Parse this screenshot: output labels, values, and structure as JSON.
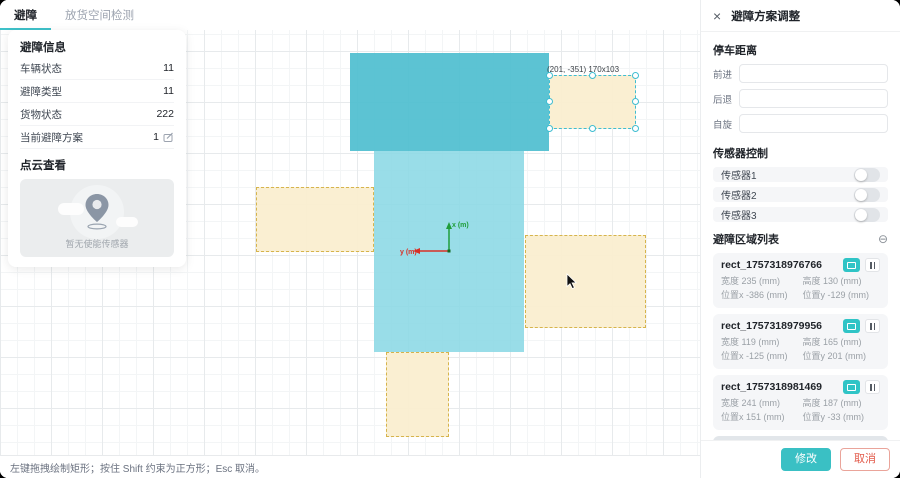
{
  "tabs": [
    {
      "label": "避障",
      "active": true
    },
    {
      "label": "放货空间检测",
      "active": false
    }
  ],
  "info_panel": {
    "title": "避障信息",
    "rows": [
      {
        "label": "车辆状态",
        "value": "11"
      },
      {
        "label": "避障类型",
        "value": "11"
      },
      {
        "label": "货物状态",
        "value": "222"
      },
      {
        "label": "当前避障方案",
        "value": "1"
      }
    ],
    "pointcloud_title": "点云查看",
    "pointcloud_empty": "暂无使能传感器"
  },
  "canvas": {
    "axis_x_label": "x (m)",
    "axis_y_label": "y (m)",
    "selected_label": "(201, -351) 170x103",
    "shapes": [
      {
        "name": "vehicle-region-top",
        "cls": "solid-dark",
        "x": 350,
        "y": 53,
        "w": 199,
        "h": 98,
        "interactable": false
      },
      {
        "name": "vehicle-region-bottom",
        "cls": "solid-light",
        "x": 374,
        "y": 151,
        "w": 150,
        "h": 201,
        "interactable": false
      },
      {
        "name": "avoid-zone-left",
        "cls": "zone",
        "x": 256,
        "y": 187,
        "w": 118,
        "h": 65,
        "interactable": true
      },
      {
        "name": "avoid-zone-right",
        "cls": "zone",
        "x": 525,
        "y": 235,
        "w": 121,
        "h": 93,
        "interactable": true
      },
      {
        "name": "avoid-zone-bottom",
        "cls": "zone",
        "x": 386,
        "y": 352,
        "w": 63,
        "h": 85,
        "interactable": true
      },
      {
        "name": "avoid-zone-selected",
        "cls": "zone selected",
        "x": 549,
        "y": 75,
        "w": 87,
        "h": 54,
        "interactable": true,
        "selected": true
      }
    ]
  },
  "status_bar": {
    "text": "左键拖拽绘制矩形；按住 Shift 约束为正方形；Esc 取消。"
  },
  "adjust_panel": {
    "close_icon": "×",
    "title": "避障方案调整",
    "stop_distance": {
      "title": "停车距离",
      "fields": [
        {
          "label": "前进",
          "value": ""
        },
        {
          "label": "后退",
          "value": ""
        },
        {
          "label": "自旋",
          "value": ""
        }
      ]
    },
    "sensor_control": {
      "title": "传感器控制",
      "sensors": [
        {
          "label": "传感器1",
          "on": false
        },
        {
          "label": "传感器2",
          "on": false
        },
        {
          "label": "传感器3",
          "on": false
        }
      ]
    },
    "area_list": {
      "title": "避障区域列表",
      "collapse_icon": "⊖",
      "items": [
        {
          "name": "rect_1757318976766",
          "width": "宽度 235 (mm)",
          "height": "高度 130 (mm)",
          "pos_x": "位置x -386 (mm)",
          "pos_y": "位置y -129 (mm)",
          "selected": false
        },
        {
          "name": "rect_1757318979956",
          "width": "宽度 119 (mm)",
          "height": "高度 165 (mm)",
          "pos_x": "位置x -125 (mm)",
          "pos_y": "位置y 201 (mm)",
          "selected": false
        },
        {
          "name": "rect_1757318981469",
          "width": "宽度 241 (mm)",
          "height": "高度 187 (mm)",
          "pos_x": "位置x 151 (mm)",
          "pos_y": "位置y -33 (mm)",
          "selected": false
        },
        {
          "name": "rect_1757318983565",
          "width": "宽度 170 (mm)",
          "height": "高度 103 (mm)",
          "pos_x": "位置x 201 (mm)",
          "pos_y": "位置y -351 (mm)",
          "selected": true
        }
      ]
    },
    "footer": {
      "confirm": "修改",
      "cancel": "取消"
    }
  },
  "colors": {
    "accent_teal": "#3ac0c4",
    "region_dark": "#4ebecf",
    "region_light": "#8bd8e5",
    "zone_fill": "#faeed0",
    "zone_border": "#d6b44c",
    "selected_border": "#3fbdd1",
    "axis_x_green": "#1f9d3a",
    "axis_y_red": "#d93025",
    "cancel_red": "#e25a4a"
  }
}
